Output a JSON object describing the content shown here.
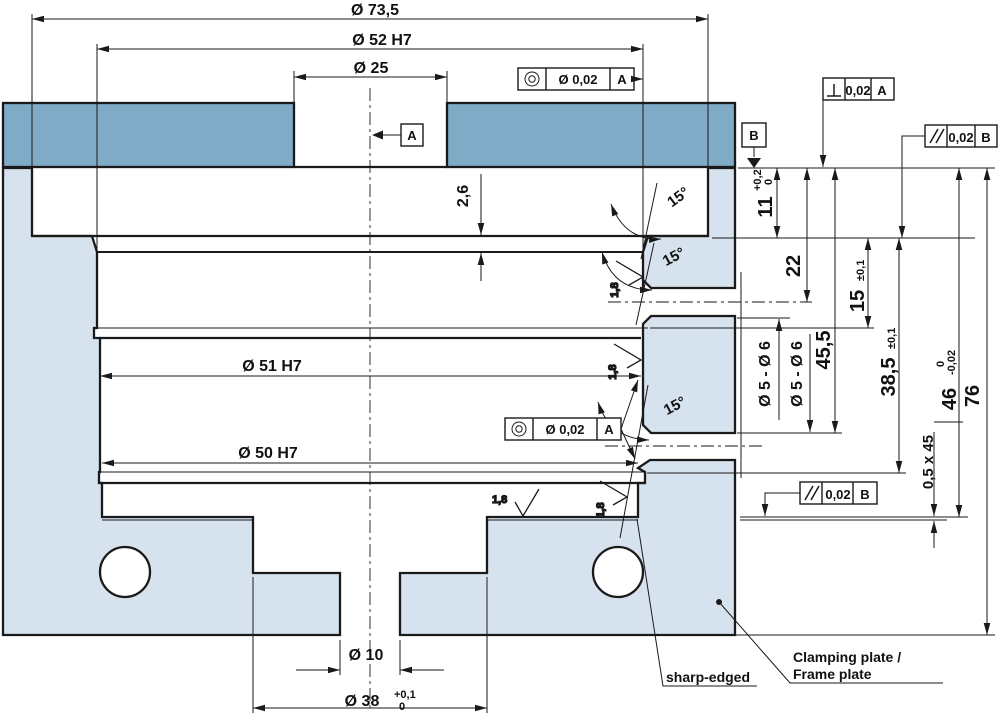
{
  "drawing": {
    "colors": {
      "plate_top": "#7fabc6",
      "body": "#d6e3ee",
      "line": "#1a1a1a",
      "background": "#ffffff"
    },
    "dims": {
      "d73_5": "Ø 73,5",
      "d52": "Ø 52 H7",
      "d25": "Ø 25",
      "d51": "Ø 51 H7",
      "d50": "Ø 50 H7",
      "d10": "Ø 10",
      "d38": "Ø 38",
      "d38_tol_hi": "+0,1",
      "d38_tol_lo": "0",
      "d11": "11",
      "d11_tol_hi": "+0,2",
      "d11_tol_lo": "0",
      "d22": "22",
      "d15": "15",
      "d15_tol": "±0,1",
      "d45_5": "45,5",
      "d38_5": "38,5",
      "d38_5_tol": "±0,1",
      "d46": "46",
      "d46_tol_hi": "0",
      "d46_tol_lo": "-0,02",
      "d76": "76",
      "chamfer": "0,5 x 45",
      "d2_6": "2,6"
    },
    "ann": {
      "angle": "15°",
      "side_hole": "Ø 5 - Ø 6",
      "roughness": "1,8"
    },
    "fcf": {
      "conc_top": {
        "tol": "Ø 0,02",
        "datum": "A"
      },
      "perp": {
        "tol": "0,02",
        "datum": "A"
      },
      "par_top": {
        "tol": "0,02",
        "datum": "B"
      },
      "par_bottom": {
        "tol": "0,02",
        "datum": "B"
      },
      "conc_mid": {
        "tol": "Ø 0,02",
        "datum": "A"
      }
    },
    "datums": {
      "a": "A",
      "b": "B"
    },
    "notes": {
      "sharp": "sharp-edged",
      "part_line1": "Clamping plate /",
      "part_line2": "Frame plate"
    }
  }
}
